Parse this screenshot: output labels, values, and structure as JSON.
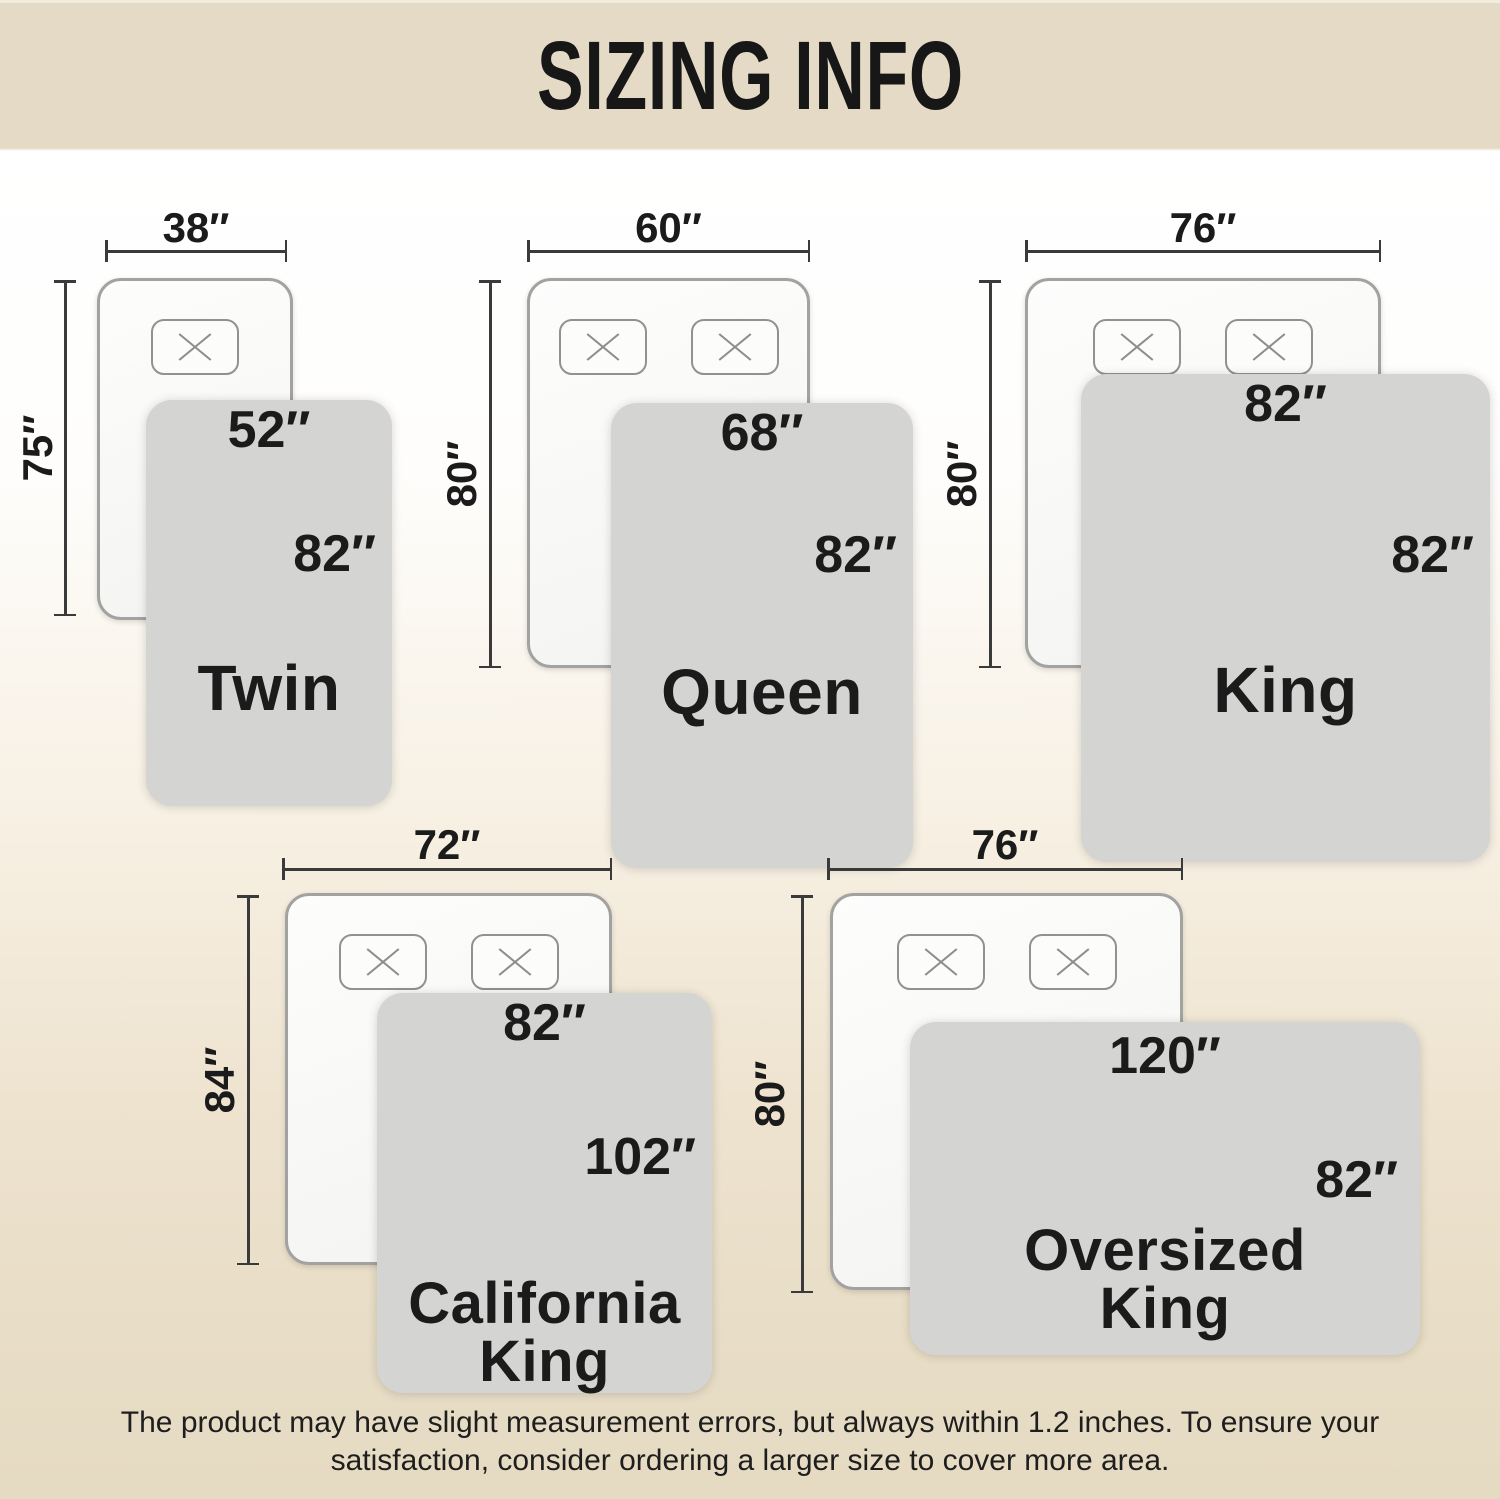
{
  "title": "SIZING INFO",
  "footer": {
    "line1": "The product may have slight measurement errors, but always within 1.2 inches. To ensure your",
    "line2": "satisfaction, consider ordering a larger size to cover more area."
  },
  "sizes": [
    {
      "name_line1": "Twin",
      "name_line2": "",
      "pillow_count": 1,
      "bed": {
        "width": "38″",
        "length": "75″"
      },
      "blanket": {
        "width": "52″",
        "length": "82″"
      }
    },
    {
      "name_line1": "Queen",
      "name_line2": "",
      "pillow_count": 2,
      "bed": {
        "width": "60″",
        "length": "80″"
      },
      "blanket": {
        "width": "68″",
        "length": "82″"
      }
    },
    {
      "name_line1": "King",
      "name_line2": "",
      "pillow_count": 2,
      "bed": {
        "width": "76″",
        "length": "80″"
      },
      "blanket": {
        "width": "82″",
        "length": "82″"
      }
    },
    {
      "name_line1": "California",
      "name_line2": "King",
      "pillow_count": 2,
      "bed": {
        "width": "72″",
        "length": "84″"
      },
      "blanket": {
        "width": "82″",
        "length": "102″"
      }
    },
    {
      "name_line1": "Oversized",
      "name_line2": "King",
      "pillow_count": 2,
      "bed": {
        "width": "76″",
        "length": "80″"
      },
      "blanket": {
        "width": "120″",
        "length": "82″"
      }
    }
  ],
  "colors": {
    "header_bg": "#e4dac6",
    "blanket": "#d4d4d2",
    "bed_fill": "#fbfbfa",
    "bed_border": "#a2a2a0",
    "pillow_border": "#91918f",
    "dim_line": "#3a3a3a",
    "text": "#1b1b1b",
    "background_bottom": "#e5dac2"
  }
}
